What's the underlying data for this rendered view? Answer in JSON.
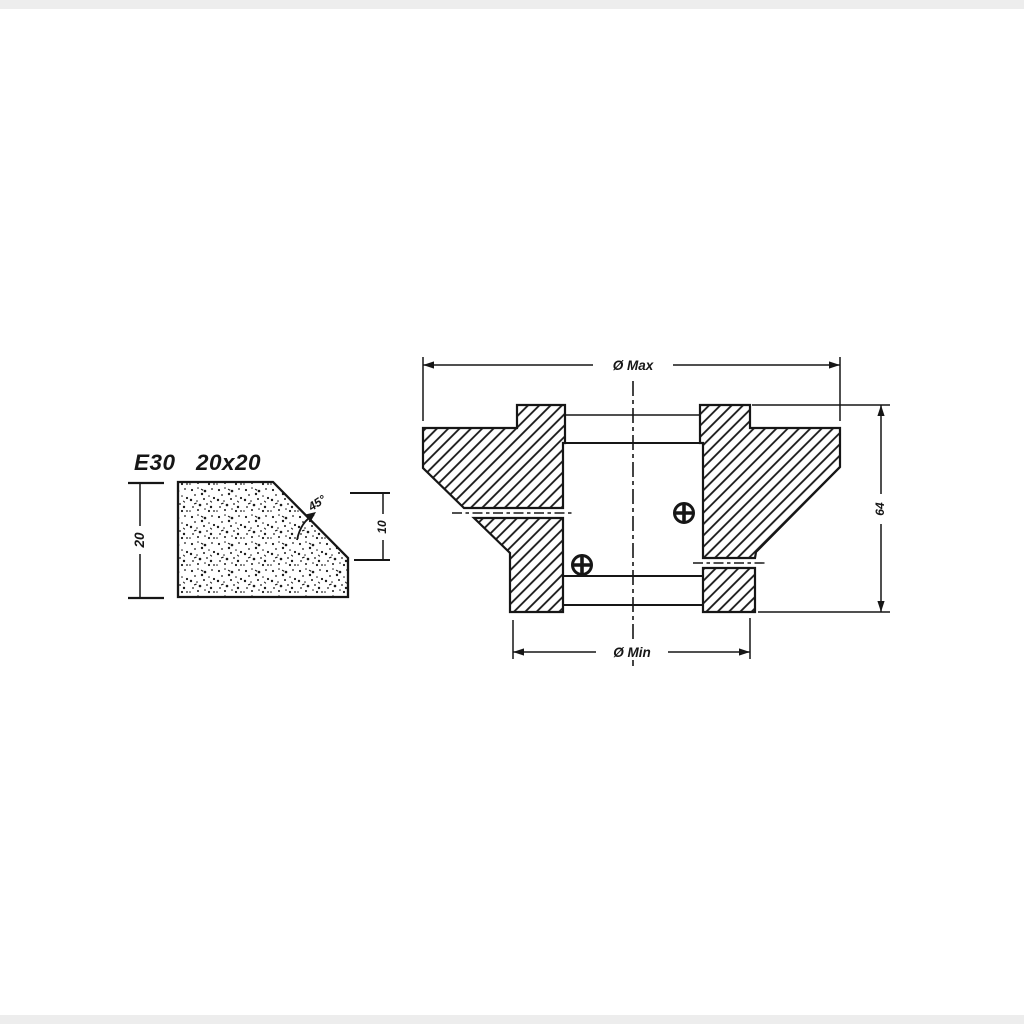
{
  "canvas": {
    "background": "#ffffff",
    "ink_color": "#161616"
  },
  "profile_figure": {
    "code": "E30",
    "size": "20x20",
    "height_dim_label": "20",
    "side_dim_label": "10",
    "angle_label": "45°"
  },
  "section_figure": {
    "max_diameter_label": "Ø Max",
    "min_diameter_label": "Ø Min",
    "height_label": "64"
  }
}
